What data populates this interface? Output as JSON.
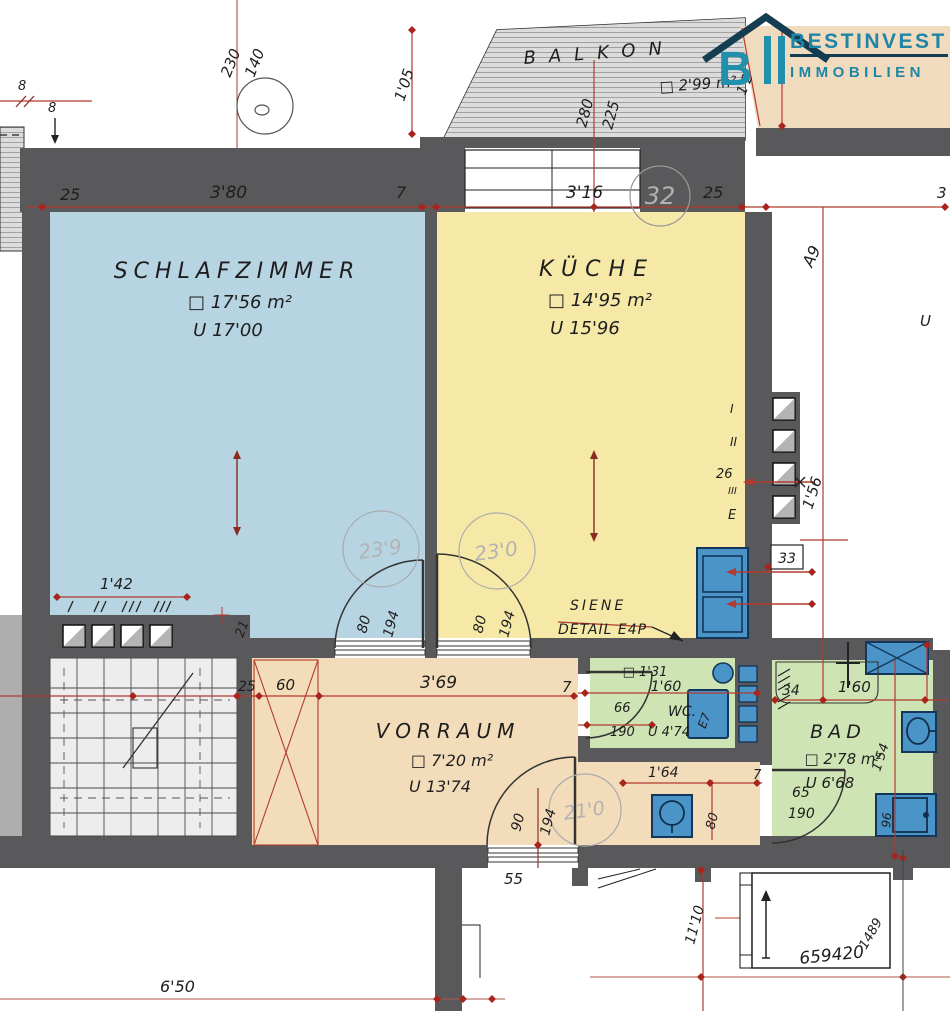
{
  "brand": {
    "title": "BESTINVEST",
    "subtitle": "IMMOBILIEN",
    "icon_letter": "B",
    "color": "#1f85a6"
  },
  "rooms": {
    "balkon": {
      "name": "BALKON",
      "area": "□ 2'99 m²",
      "dim_a": "280",
      "dim_b": "225",
      "dim_side": "1'05"
    },
    "schlafzimmer": {
      "name": "SCHLAFZIMMER",
      "area": "□ 17'56 m²",
      "perimeter": "U 17'00",
      "dims": {
        "left": "25",
        "width": "3'80",
        "wall": "7",
        "bottom": "1'42",
        "step": "21"
      },
      "door": {
        "circle": "23'9",
        "w": "80",
        "h": "194"
      }
    },
    "kueche": {
      "name": "KÜCHE",
      "area": "□ 14'95 m²",
      "perimeter": "U 15'96",
      "dims": {
        "width": "3'16",
        "pos": "32",
        "right": "25"
      },
      "door": {
        "circle": "23'0",
        "w": "80",
        "h": "194"
      },
      "note1": "SIENE",
      "note2": "DETAIL E4P"
    },
    "vorraum": {
      "name": "VORRAUM",
      "area": "□ 7'20 m²",
      "perimeter": "U 13'74",
      "dims": {
        "left": "25",
        "shaft": "60",
        "width": "3'69",
        "wall": "7",
        "niche": "1'64",
        "niche_w": "80",
        "niche_wall": "7",
        "below": "55"
      },
      "door": {
        "circle": "21'0",
        "w": "90",
        "h": "194"
      }
    },
    "wc": {
      "name": "WC.",
      "area": "□ 1'31",
      "width": "1'60",
      "perimeter": "U 4'74",
      "door_w": "66",
      "door_h": "190",
      "cistern": "E7"
    },
    "bad": {
      "name": "BAD",
      "area": "□ 2'78 m²",
      "perimeter": "U 6'68",
      "dims": {
        "a": "34",
        "b": "1'60",
        "side": "1'54",
        "appliance": "96"
      },
      "door_w": "65",
      "door_h": "190"
    }
  },
  "annotations": {
    "top_left": {
      "d1": "230",
      "d2": "140",
      "e1": "8",
      "e2": "8"
    },
    "top_right": {
      "slant": "1'2"
    },
    "right": {
      "a9": "A9",
      "u": "U",
      "v156": "1'56",
      "flues": [
        "I",
        "II",
        "26",
        "III",
        "E"
      ],
      "box33": "33",
      "edge": "3"
    },
    "bottom": {
      "d650": "6'50",
      "d1110": "11'10",
      "plan_no": "659420",
      "plan_no2": "1489"
    }
  }
}
